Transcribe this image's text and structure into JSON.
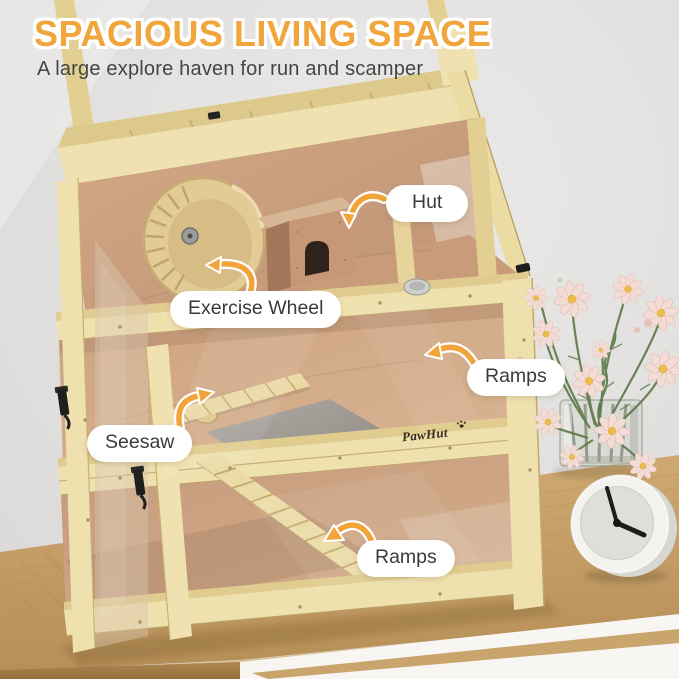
{
  "header": {
    "title": "SPACIOUS LIVING SPACE",
    "subtitle": "A large explore haven for run and scamper"
  },
  "callouts": {
    "hut": "Hut",
    "exercise_wheel": "Exercise Wheel",
    "ramps_upper": "Ramps",
    "seesaw": "Seesaw",
    "ramps_lower": "Ramps"
  },
  "brand": {
    "logo": "PawHut"
  },
  "colors": {
    "title_orange": "#F0A63C",
    "callout_arrow": "#F2A43B",
    "pill_background": "#FFFFFF",
    "label_text": "#3A3A38",
    "wall_gray": "#E4E3E1",
    "wood_frame": "#EFE1AD",
    "plywood_floor": "#C89C7B",
    "table_oak": "#C19A62",
    "petal_pink": "#F3DCD5",
    "flower_center": "#ECBD49"
  }
}
